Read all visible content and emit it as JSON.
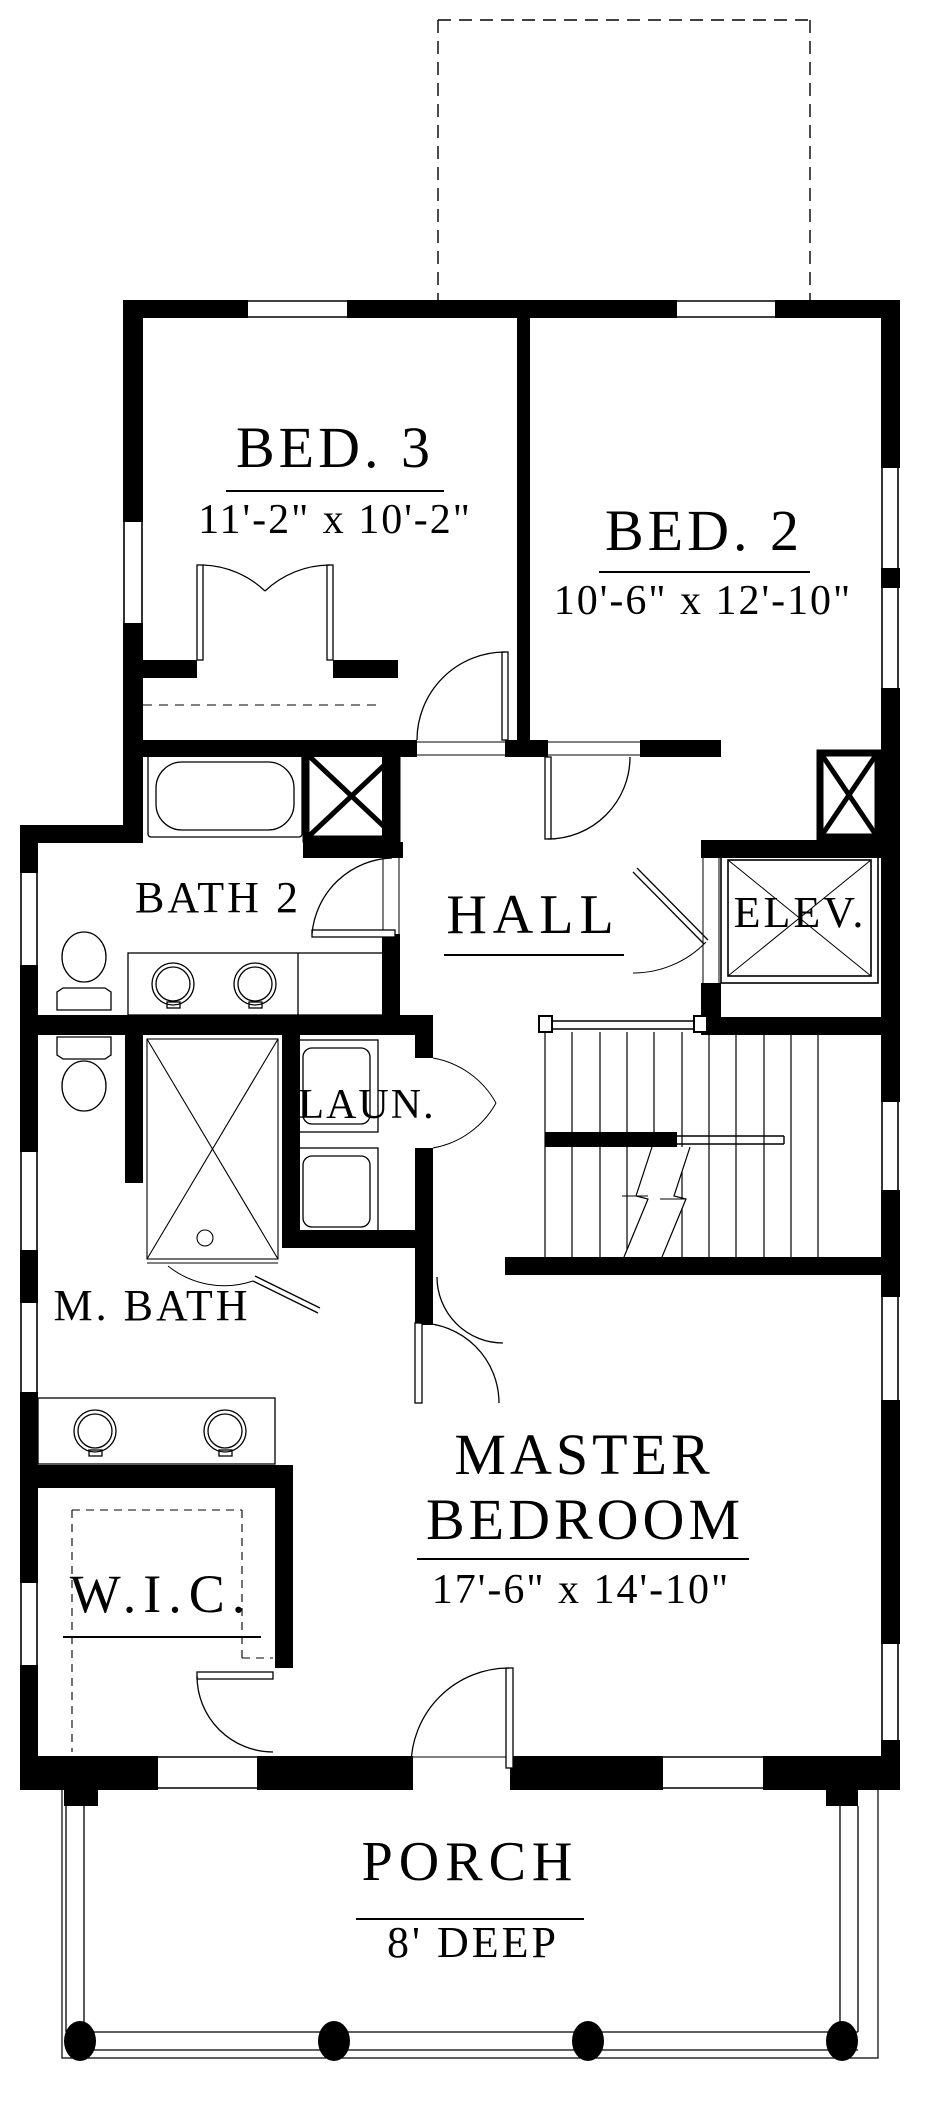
{
  "plan": {
    "title": "Second floor plan",
    "colors": {
      "wall": "#000000",
      "background": "#ffffff",
      "line": "#000000"
    },
    "rooms": {
      "bed3": {
        "name": "BED. 3",
        "dims": "11'-2\" x 10'-2\""
      },
      "bed2": {
        "name": "BED. 2",
        "dims": "10'-6\" x 12'-10\""
      },
      "bath2": {
        "name": "BATH 2"
      },
      "hall": {
        "name": "HALL"
      },
      "elevator": {
        "name": "ELEV."
      },
      "laundry": {
        "name": "LAUN."
      },
      "master_bath": {
        "name": "M. BATH"
      },
      "master_bedroom": {
        "name_line1": "MASTER",
        "name_line2": "BEDROOM",
        "dims": "17'-6\" x 14'-10\""
      },
      "walk_in_closet": {
        "name": "W.I.C."
      },
      "porch": {
        "name": "PORCH",
        "dims": "8' DEEP"
      }
    }
  }
}
